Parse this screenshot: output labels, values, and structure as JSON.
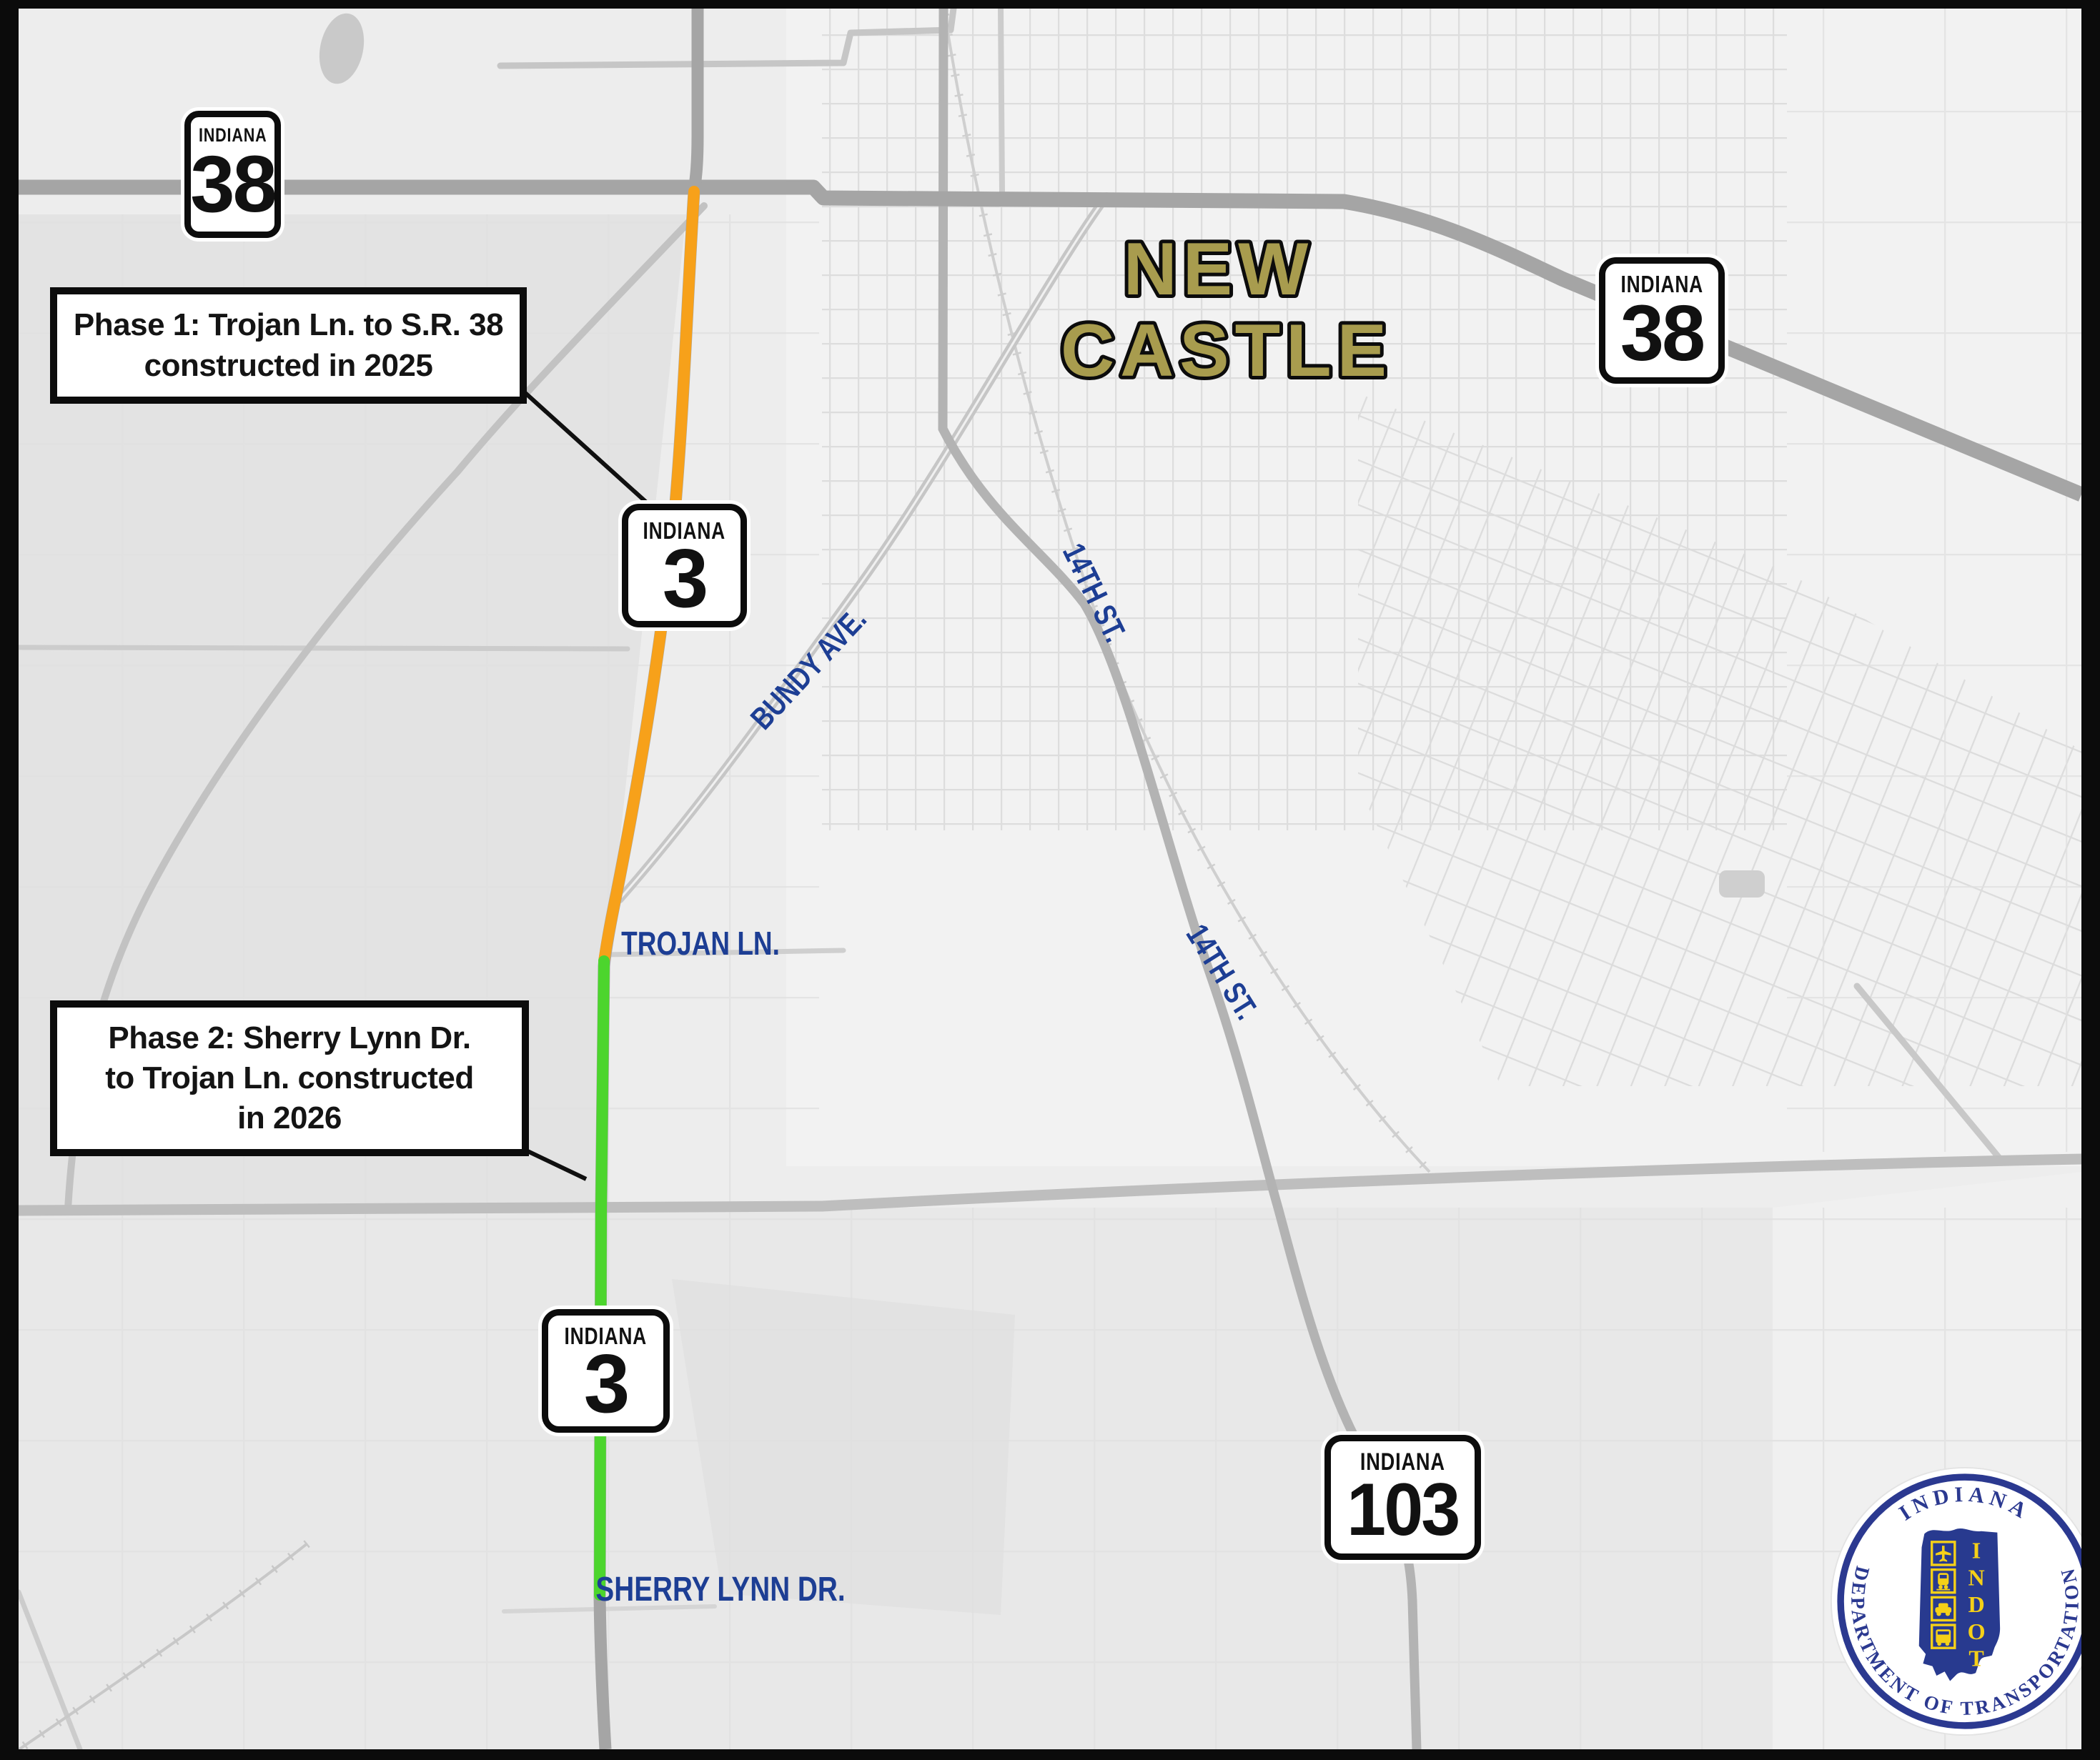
{
  "map": {
    "city_label": {
      "line1": "NEW",
      "line2": "CASTLE"
    },
    "labels": {
      "bundy_ave": "BUNDY AVE.",
      "fourteenth_st_north": "14TH ST.",
      "fourteenth_st_south": "14TH ST.",
      "trojan_ln": "TROJAN LN.",
      "sherry_lynn_dr": "SHERRY LYNN DR."
    },
    "shields": [
      {
        "state": "INDIANA",
        "number": "38"
      },
      {
        "state": "INDIANA",
        "number": "38"
      },
      {
        "state": "INDIANA",
        "number": "3"
      },
      {
        "state": "INDIANA",
        "number": "3"
      },
      {
        "state": "INDIANA",
        "number": "103"
      }
    ],
    "callouts": {
      "phase1": {
        "line1": "Phase 1: Trojan Ln. to S.R. 38",
        "line2": "constructed in 2025"
      },
      "phase2": {
        "line1": "Phase 2: Sherry Lynn Dr.",
        "line2": "to Trojan Ln. constructed",
        "line3": "in 2026"
      }
    },
    "colors": {
      "phase1_route": "#F7A11A",
      "phase2_route": "#4CD52D",
      "street_label_blue": "#1D3E94",
      "city_label_olive": "#A89C4E"
    }
  },
  "logo": {
    "ring_top": "INDIANA",
    "ring_bottom": "DEPARTMENT OF TRANSPORTATION",
    "acronym_letters": [
      "I",
      "N",
      "D",
      "O",
      "T"
    ]
  }
}
